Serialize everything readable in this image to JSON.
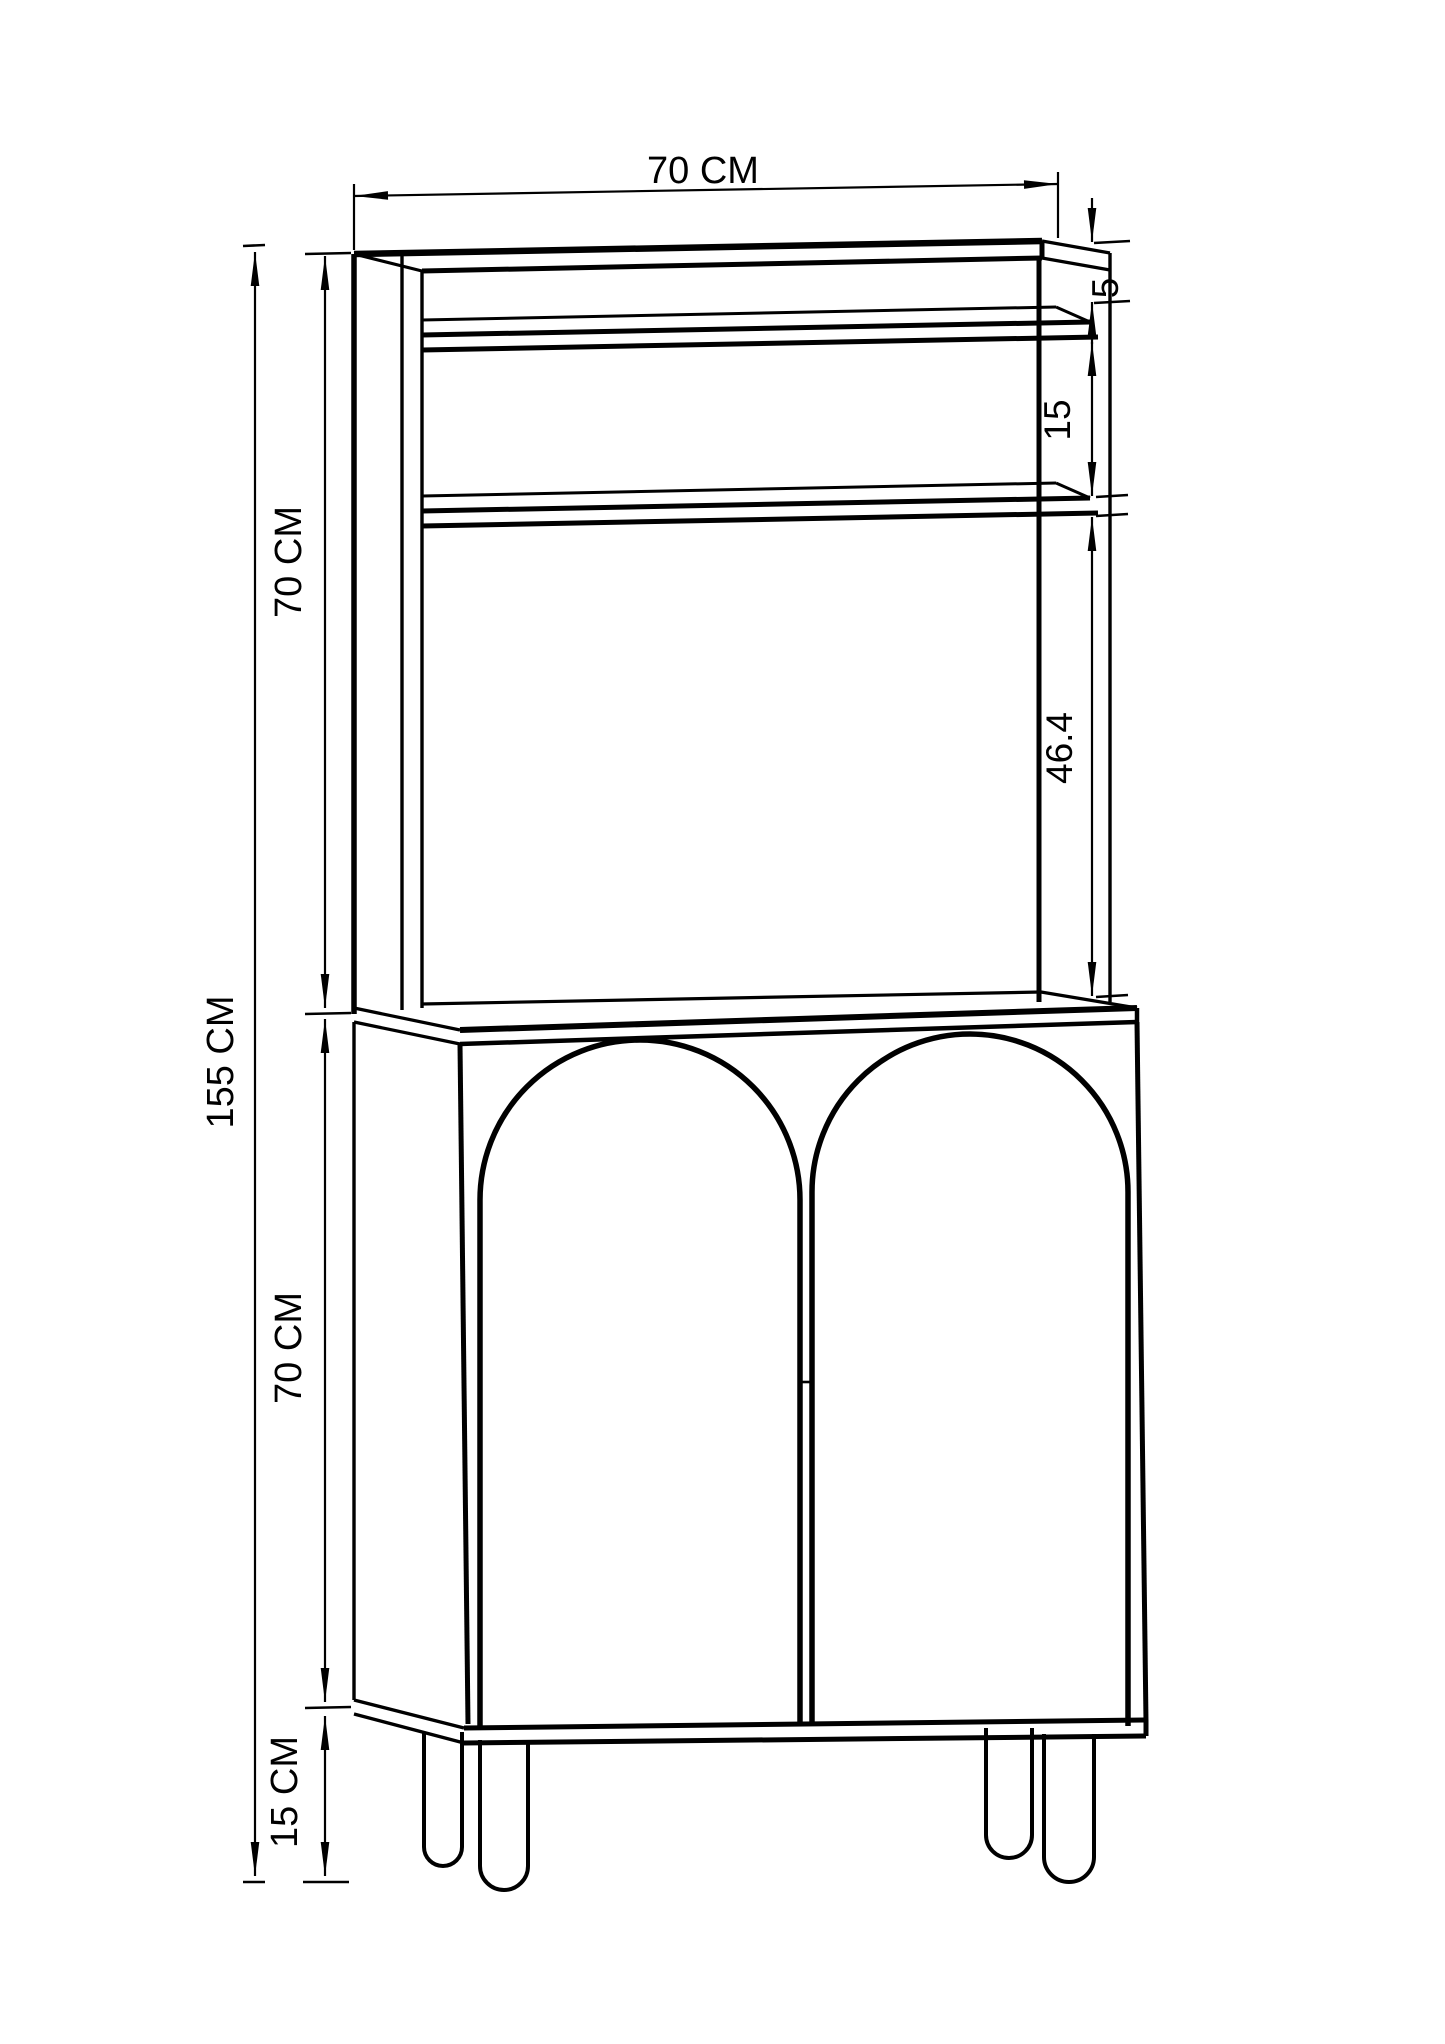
{
  "drawing": {
    "kind": "furniture dimension drawing",
    "colors": {
      "ink": "#000000",
      "paper": "#ffffff"
    }
  },
  "dimensions": {
    "top_width": "70 CM",
    "board_thickness": "5",
    "shelf_spacing": "15",
    "open_height": "46.4",
    "total_height": "155 CM",
    "hutch_height": "70 CM",
    "cabinet_height": "70 CM",
    "leg_height": "15 CM"
  }
}
